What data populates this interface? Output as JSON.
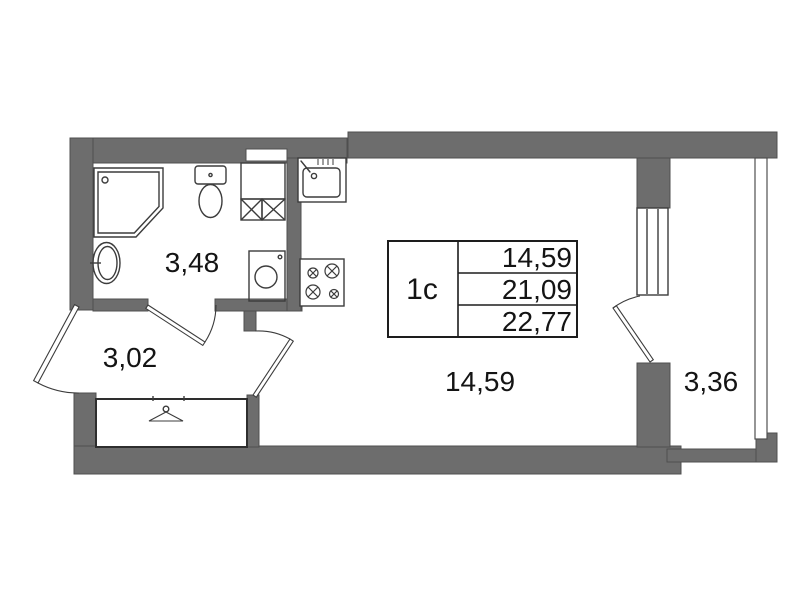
{
  "unit": {
    "type_label": "1с"
  },
  "area_table": {
    "type_label": "1с",
    "rows": [
      {
        "value": "14,59"
      },
      {
        "value": "21,09"
      },
      {
        "value": "22,77"
      }
    ]
  },
  "room_labels": {
    "bathroom": "3,48",
    "hallway": "3,02",
    "living_room": "14,59",
    "balcony": "3,36"
  },
  "icons": {
    "shower": "shower-icon",
    "toilet": "toilet-icon",
    "washbasin": "washbasin-icon",
    "washing_machine": "washing-machine-icon",
    "vent_shaft": "vent-shaft-icon",
    "kitchen_sink": "kitchen-sink-icon",
    "stove": "stove-icon",
    "hanger": "hanger-icon",
    "door_swing": "door-swing-arc",
    "window": "window-glyph"
  },
  "colors": {
    "wall_fill": "#6d6d6d",
    "wall_edge": "#4f4f4f",
    "line": "#3c3c3c",
    "text": "#141414",
    "background": "#ffffff"
  }
}
